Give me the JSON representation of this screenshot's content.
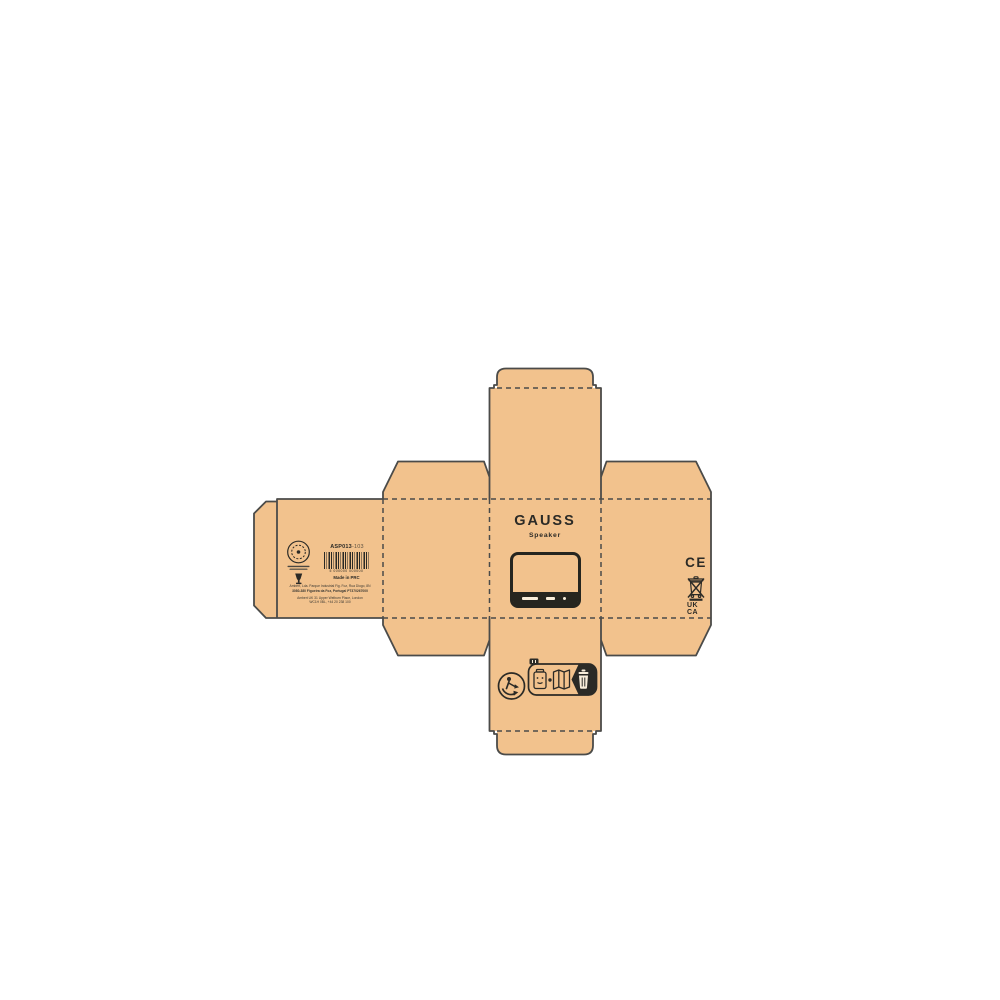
{
  "colors": {
    "background": "#FFFFFF",
    "kraft": "#F2C28D",
    "dieline_stroke": "#4B4B49",
    "print": "#2B2A26",
    "print_light": "#F8EDDA"
  },
  "front_panel": {
    "brand": "GAUSS",
    "product": "Speaker",
    "illustration_icon": "speaker-device-icon"
  },
  "back_panel": {
    "emblem_icon": "circular-stamp-icon",
    "emblem_glyph_icon": "recycling-glyph-icon",
    "sku_code": "ASP013",
    "sku_variant": "-103",
    "barcode_icon": "ean-barcode-icon",
    "barcode_digits": "5 000000 000000",
    "made_in": "Made in PRC",
    "maker_line1": "Ambert, Lda. Parque Industrial Fig. Foz, Rua Diogo, 8N",
    "maker_line2": "3080-380 Figueira da Foz, Portugal PT370267000",
    "maker_line3": "Ambert UK 31 Upper Welburn Place, London",
    "maker_line4": "WC1H 0BL, +44 20 238 100"
  },
  "right_panel": {
    "ce_mark": "CE",
    "weee_icon": "weee-crossed-bin-icon",
    "ukca_line1": "UK",
    "ukca_line2": "CA"
  },
  "bottom_panel": {
    "triman_icon": "triman-recycling-icon",
    "sorting_label_icons": [
      "packaging-box-icon",
      "separator-dot",
      "leaflet-icon",
      "recycling-bin-icon"
    ]
  }
}
